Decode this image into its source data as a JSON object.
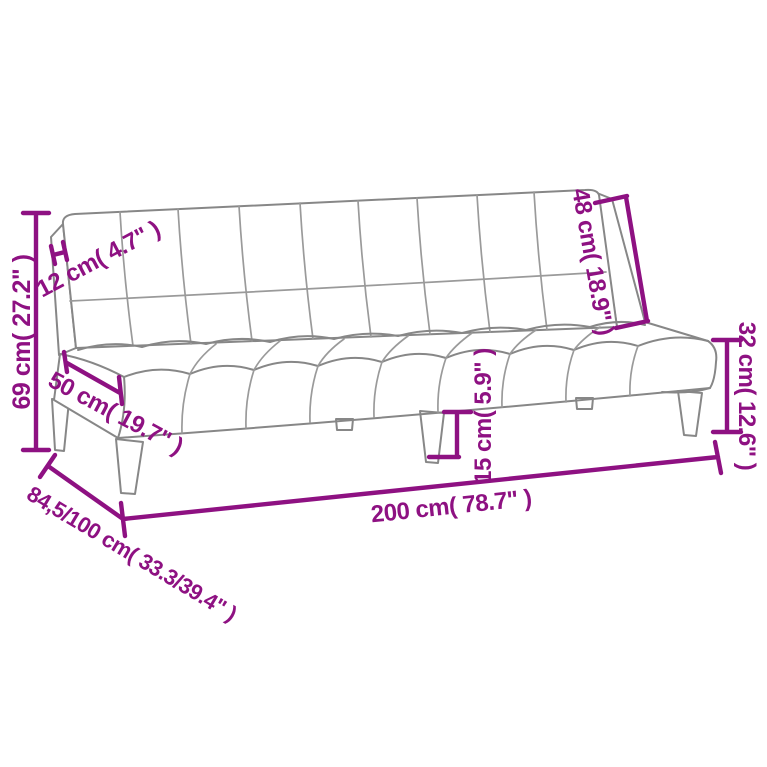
{
  "diagram": {
    "type": "product-dimension-diagram",
    "subject": "sofa-bed-line-drawing",
    "colors": {
      "background": "#ffffff",
      "drawing_outline": "#878787",
      "dimension_accent": "#8e1182"
    },
    "labels": {
      "overall_height": "69 cm( 27.2\" )",
      "backrest_thickness": "12 cm( 4.7\" )",
      "seat_depth": "50 cm( 19.7\" )",
      "backrest_height": "48 cm( 18.9\" )",
      "seat_height": "32 cm( 12.6\" )",
      "leg_height": "15 cm( 5.9\" )",
      "overall_width": "200 cm( 78.7\" )",
      "overall_depth": "84,5/100 cm( 33.3/39.4\" )"
    }
  }
}
